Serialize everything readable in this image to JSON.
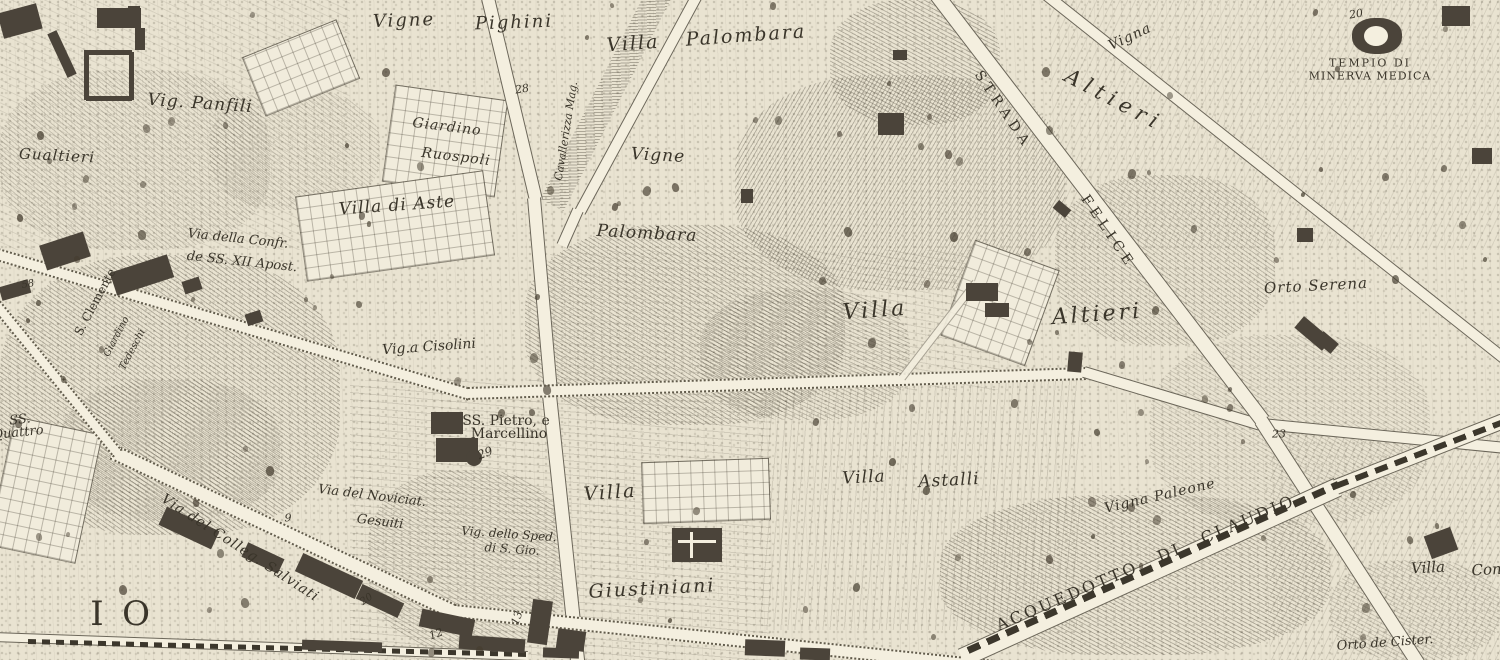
{
  "map": {
    "type": "engraved-city-map",
    "colors": {
      "parchment": "#e9e3d1",
      "road": "#f4efdf",
      "ink": "#3a352a",
      "building": "#4b443a"
    },
    "labels": [
      {
        "id": "vig-panfili",
        "t": "Vig. Panfili",
        "x": 200,
        "y": 104,
        "r": 4,
        "s": 17,
        "st": "it",
        "ls": 1
      },
      {
        "id": "gualtieri",
        "t": "Gualtieri",
        "x": 57,
        "y": 156,
        "r": 3,
        "s": 15,
        "st": "it",
        "ls": 1
      },
      {
        "id": "vigne-pighini-1",
        "t": "Vigne",
        "x": 404,
        "y": 21,
        "r": -2,
        "s": 18,
        "st": "it",
        "ls": 2
      },
      {
        "id": "vigne-pighini-2",
        "t": "Pighini",
        "x": 514,
        "y": 23,
        "r": -2,
        "s": 18,
        "st": "it",
        "ls": 2
      },
      {
        "id": "giardino-ruospoli-1",
        "t": "Giardino",
        "x": 447,
        "y": 127,
        "r": 7,
        "s": 14,
        "st": "it",
        "ls": 1
      },
      {
        "id": "giardino-ruospoli-2",
        "t": "Ruospoli",
        "x": 456,
        "y": 157,
        "r": 7,
        "s": 14,
        "st": "it",
        "ls": 1
      },
      {
        "id": "num-28",
        "t": "28",
        "x": 522,
        "y": 89,
        "r": -10,
        "s": 11,
        "st": "num"
      },
      {
        "id": "alley-label",
        "t": "Cavallerizza Mag.",
        "x": 566,
        "y": 131,
        "r": -81,
        "s": 11,
        "st": "it"
      },
      {
        "id": "villa-palombara-1",
        "t": "Villa",
        "x": 633,
        "y": 44,
        "r": -4,
        "s": 19,
        "st": "it",
        "ls": 2
      },
      {
        "id": "villa-palombara-2",
        "t": "Palombara",
        "x": 746,
        "y": 36,
        "r": -4,
        "s": 19,
        "st": "it",
        "ls": 2
      },
      {
        "id": "vigne-center",
        "t": "Vigne",
        "x": 658,
        "y": 156,
        "r": 3,
        "s": 17,
        "st": "it",
        "ls": 1
      },
      {
        "id": "palombara-center",
        "t": "Palombara",
        "x": 647,
        "y": 234,
        "r": 3,
        "s": 17,
        "st": "it",
        "ls": 1
      },
      {
        "id": "villa-altieri-1",
        "t": "Villa",
        "x": 875,
        "y": 311,
        "r": -4,
        "s": 22,
        "st": "it",
        "ls": 3
      },
      {
        "id": "villa-altieri-2",
        "t": "Altieri",
        "x": 1097,
        "y": 315,
        "r": -4,
        "s": 22,
        "st": "it",
        "ls": 3
      },
      {
        "id": "altieri-diagonal",
        "t": "Altieri",
        "x": 1114,
        "y": 100,
        "r": 28,
        "s": 21,
        "st": "it",
        "ls": 6
      },
      {
        "id": "vigna-topright",
        "t": "Vigna",
        "x": 1130,
        "y": 37,
        "r": -25,
        "s": 14,
        "st": "it",
        "ls": 1
      },
      {
        "id": "strada",
        "t": "STRADA",
        "x": 1003,
        "y": 110,
        "r": 56,
        "s": 14,
        "st": "rm",
        "ls": 5
      },
      {
        "id": "felice",
        "t": "FELICE",
        "x": 1108,
        "y": 232,
        "r": 56,
        "s": 14,
        "st": "rm",
        "ls": 5
      },
      {
        "id": "tempio-line1",
        "t": "TEMPIO DI",
        "x": 1370,
        "y": 63,
        "r": 0,
        "s": 11,
        "st": "rm",
        "ls": 2
      },
      {
        "id": "tempio-line2",
        "t": "MINERVA MEDICA",
        "x": 1370,
        "y": 76,
        "r": 0,
        "s": 11,
        "st": "rm",
        "ls": 1
      },
      {
        "id": "num-20-tempio",
        "t": "20",
        "x": 1356,
        "y": 14,
        "r": -10,
        "s": 11,
        "st": "num"
      },
      {
        "id": "orto-serena",
        "t": "Orto Serena",
        "x": 1316,
        "y": 286,
        "r": -3,
        "s": 15,
        "st": "it",
        "ls": 1
      },
      {
        "id": "s-clemente",
        "t": "S. Clemente",
        "x": 95,
        "y": 302,
        "r": -62,
        "s": 12,
        "st": "rm2"
      },
      {
        "id": "giardino-rot-1",
        "t": "Giardino",
        "x": 117,
        "y": 337,
        "r": -62,
        "s": 10,
        "st": "it"
      },
      {
        "id": "giardino-rot-2",
        "t": "Tedeschi",
        "x": 133,
        "y": 350,
        "r": -62,
        "s": 10,
        "st": "it"
      },
      {
        "id": "via-confr-1",
        "t": "Via della Confr.",
        "x": 238,
        "y": 239,
        "r": 6,
        "s": 13,
        "st": "it"
      },
      {
        "id": "via-confr-2",
        "t": "de SS. XII Apost.",
        "x": 242,
        "y": 262,
        "r": 6,
        "s": 13,
        "st": "it"
      },
      {
        "id": "num-58",
        "t": "58",
        "x": 28,
        "y": 285,
        "r": -10,
        "s": 10,
        "st": "num"
      },
      {
        "id": "ss-quattro-1",
        "t": "SS.",
        "x": 20,
        "y": 420,
        "r": -6,
        "s": 13,
        "st": "it"
      },
      {
        "id": "ss-quattro-2",
        "t": "Quattro",
        "x": 18,
        "y": 433,
        "r": -6,
        "s": 13,
        "st": "it"
      },
      {
        "id": "villa-di-aste",
        "t": "Villa di Aste",
        "x": 397,
        "y": 206,
        "r": -4,
        "s": 17,
        "st": "it",
        "ls": 1
      },
      {
        "id": "vigna-cisolini",
        "t": "Vig.a Cisolini",
        "x": 429,
        "y": 347,
        "r": -4,
        "s": 14,
        "st": "it"
      },
      {
        "id": "ss-pietro-1",
        "t": "SS. Pietro, e",
        "x": 506,
        "y": 421,
        "r": 0,
        "s": 14,
        "st": "rm2"
      },
      {
        "id": "ss-pietro-2",
        "t": "Marcellino",
        "x": 509,
        "y": 434,
        "r": 0,
        "s": 14,
        "st": "rm2"
      },
      {
        "id": "num-29",
        "t": "29",
        "x": 485,
        "y": 453,
        "r": -20,
        "s": 12,
        "st": "num"
      },
      {
        "id": "villa-center",
        "t": "Villa",
        "x": 610,
        "y": 493,
        "r": -4,
        "s": 19,
        "st": "it",
        "ls": 2
      },
      {
        "id": "villa-astalli-1",
        "t": "Villa",
        "x": 864,
        "y": 478,
        "r": -3,
        "s": 17,
        "st": "it",
        "ls": 1
      },
      {
        "id": "villa-astalli-2",
        "t": "Astalli",
        "x": 949,
        "y": 481,
        "r": -3,
        "s": 17,
        "st": "it",
        "ls": 1
      },
      {
        "id": "vigna-paleone",
        "t": "Vigna Paleone",
        "x": 1160,
        "y": 496,
        "r": -13,
        "s": 14,
        "st": "it",
        "ls": 1
      },
      {
        "id": "vig-spedale-1",
        "t": "Vig. dello Sped.",
        "x": 509,
        "y": 534,
        "r": 4,
        "s": 12,
        "st": "it"
      },
      {
        "id": "vig-spedale-2",
        "t": "di S. Gio.",
        "x": 512,
        "y": 549,
        "r": 4,
        "s": 12,
        "st": "it"
      },
      {
        "id": "giustiniani",
        "t": "Giustiniani",
        "x": 652,
        "y": 589,
        "r": -3,
        "s": 19,
        "st": "it",
        "ls": 2
      },
      {
        "id": "via-noviciato-1",
        "t": "Via del Noviciat.",
        "x": 372,
        "y": 496,
        "r": 7,
        "s": 13,
        "st": "it"
      },
      {
        "id": "via-noviciato-2",
        "t": "Gesuiti",
        "x": 380,
        "y": 522,
        "r": 7,
        "s": 13,
        "st": "it"
      },
      {
        "id": "via-salviati",
        "t": "Via del Colleg. Salviati",
        "x": 240,
        "y": 548,
        "r": 33,
        "s": 14,
        "st": "it",
        "ls": 1
      },
      {
        "id": "district-letter-i",
        "t": "I",
        "x": 97,
        "y": 614,
        "r": 0,
        "s": 34,
        "st": "rm2"
      },
      {
        "id": "district-letter-o",
        "t": "O",
        "x": 136,
        "y": 614,
        "r": 0,
        "s": 34,
        "st": "rm2"
      },
      {
        "id": "acquedotto-claudio",
        "t": "ACQUEDOTTO DI CLAUDIO",
        "x": 1146,
        "y": 563,
        "r": -23,
        "s": 16,
        "st": "rm",
        "ls": 3,
        "ws": 14
      },
      {
        "id": "orto-de-cister",
        "t": "Orto de Cister.",
        "x": 1385,
        "y": 643,
        "r": -4,
        "s": 13,
        "st": "it"
      },
      {
        "id": "villa-con-1",
        "t": "Villa",
        "x": 1428,
        "y": 568,
        "r": -3,
        "s": 15,
        "st": "it"
      },
      {
        "id": "villa-con-2",
        "t": "Con.",
        "x": 1489,
        "y": 570,
        "r": -3,
        "s": 15,
        "st": "it"
      },
      {
        "id": "num-13",
        "t": "13",
        "x": 517,
        "y": 618,
        "r": -70,
        "s": 11,
        "st": "num"
      },
      {
        "id": "num-12",
        "t": "12",
        "x": 436,
        "y": 634,
        "r": -20,
        "s": 11,
        "st": "num"
      },
      {
        "id": "num-23",
        "t": "23",
        "x": 1279,
        "y": 434,
        "r": 0,
        "s": 11,
        "st": "num"
      },
      {
        "id": "num-20-road",
        "t": "20",
        "x": 367,
        "y": 600,
        "r": -35,
        "s": 10,
        "st": "num"
      },
      {
        "id": "num-9",
        "t": "9",
        "x": 288,
        "y": 518,
        "r": 0,
        "s": 11,
        "st": "num"
      }
    ]
  }
}
